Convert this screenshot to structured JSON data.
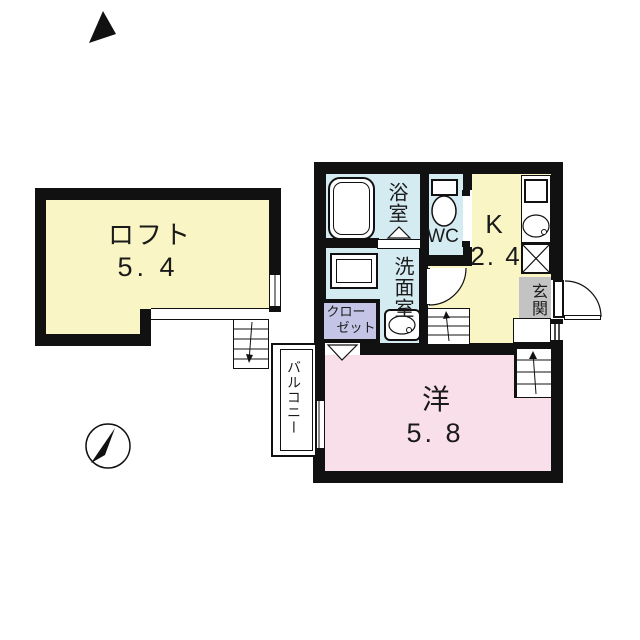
{
  "plan_title": "1K apartment floor plan with loft",
  "rooms": {
    "loft": {
      "label": "ロフト",
      "size": "5. 4"
    },
    "western_room": {
      "label": "洋",
      "size": "5. 8"
    },
    "kitchen": {
      "label": "K",
      "size": "2. 4"
    },
    "bathroom": {
      "label": "浴室"
    },
    "toilet": {
      "label": "WC"
    },
    "washroom": {
      "label": "洗面室"
    },
    "closet": {
      "label_line1": "クロー",
      "label_line2": "ゼット"
    },
    "entrance": {
      "label": "玄関"
    },
    "balcony": {
      "label": "バルコニー"
    }
  },
  "icons": {
    "compass": "north-compass",
    "north_mark": "north-arrow-triangle",
    "fixtures": [
      "bathtub",
      "washer-pan",
      "vanity-sink",
      "toilet",
      "kitchen-sink",
      "gas-stove",
      "stairs",
      "loft-ladder",
      "door-swing-arcs",
      "windows"
    ]
  },
  "colors": {
    "loft_fill": "#F9F5C4",
    "kitchen_fill": "#F9F5C4",
    "wet_area_fill": "#D4EBF2",
    "western_room_fill": "#F9DFE9",
    "closet_fill": "#C4C4E6",
    "entrance_fill": "#C3C3C3",
    "wall": "#111111"
  }
}
